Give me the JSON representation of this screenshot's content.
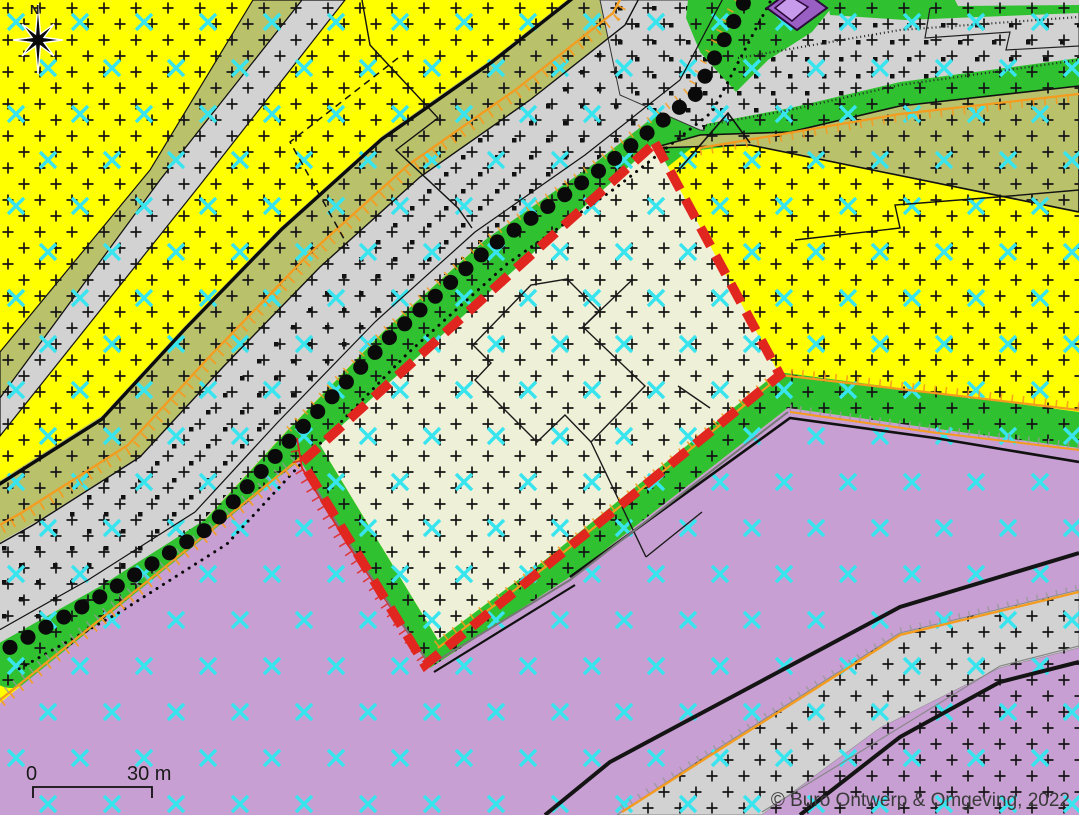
{
  "map": {
    "compass_label": "N",
    "scale_bar": {
      "start_label": "0",
      "end_label": "30 m"
    },
    "copyright": "© Buro Ontwerp & Omgeving, 2022",
    "legend": {
      "zones": [
        {
          "name": "yellow-zone",
          "color": "#ffff00"
        },
        {
          "name": "purple-zone",
          "color": "#c89fd3"
        },
        {
          "name": "green-strip",
          "color": "#2fc12f"
        },
        {
          "name": "road-grey",
          "color": "#d2d2d2"
        },
        {
          "name": "olive-overlay",
          "color": "#b9c16b"
        },
        {
          "name": "plan-area-cream",
          "color": "#eff0d8"
        }
      ],
      "marks": [
        {
          "name": "plus-hatch",
          "color": "#151515"
        },
        {
          "name": "x-hatch",
          "color": "#38e4ee"
        },
        {
          "name": "tree-row-dots",
          "color": "#0a0a0a"
        },
        {
          "name": "plan-boundary-dashed",
          "color": "#e1251f"
        },
        {
          "name": "orange-tick-line",
          "color": "#f59b1e"
        },
        {
          "name": "red-tick-line",
          "color": "#e1251f"
        },
        {
          "name": "building-symbol",
          "color": "#9a5fc2"
        }
      ]
    }
  }
}
